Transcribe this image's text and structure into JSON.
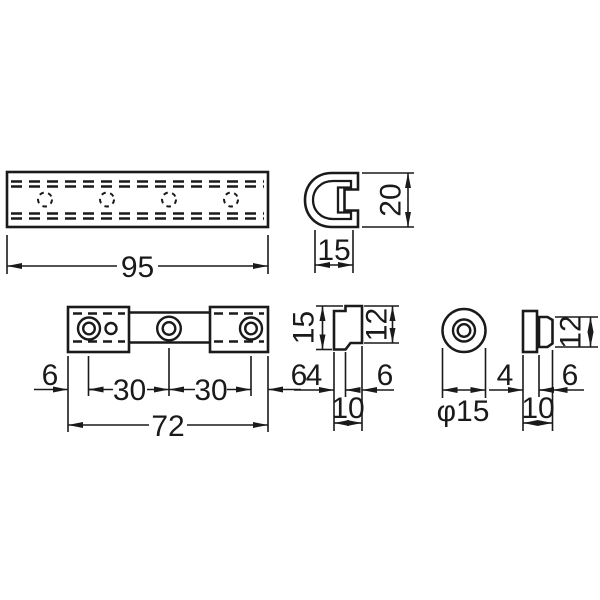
{
  "drawing_type": "technical-dimension-drawing",
  "colors": {
    "line": "#1a1a1a",
    "background": "#ffffff"
  },
  "views": {
    "rail_top": {
      "length": "95"
    },
    "rail_section": {
      "height": "20",
      "width": "15"
    },
    "bracket_top": {
      "end_left": "6",
      "pitch_left": "30",
      "pitch_right": "30",
      "end_right": "6",
      "length": "72"
    },
    "bracket_section": {
      "height": "15",
      "boss_height": "12",
      "flange_thickness": "4",
      "boss_depth": "6",
      "depth": "10"
    },
    "cap_front": {
      "diameter": "φ15"
    },
    "cap_section": {
      "boss_height": "12",
      "flange_thickness": "4",
      "boss_depth": "6",
      "depth": "10"
    }
  }
}
